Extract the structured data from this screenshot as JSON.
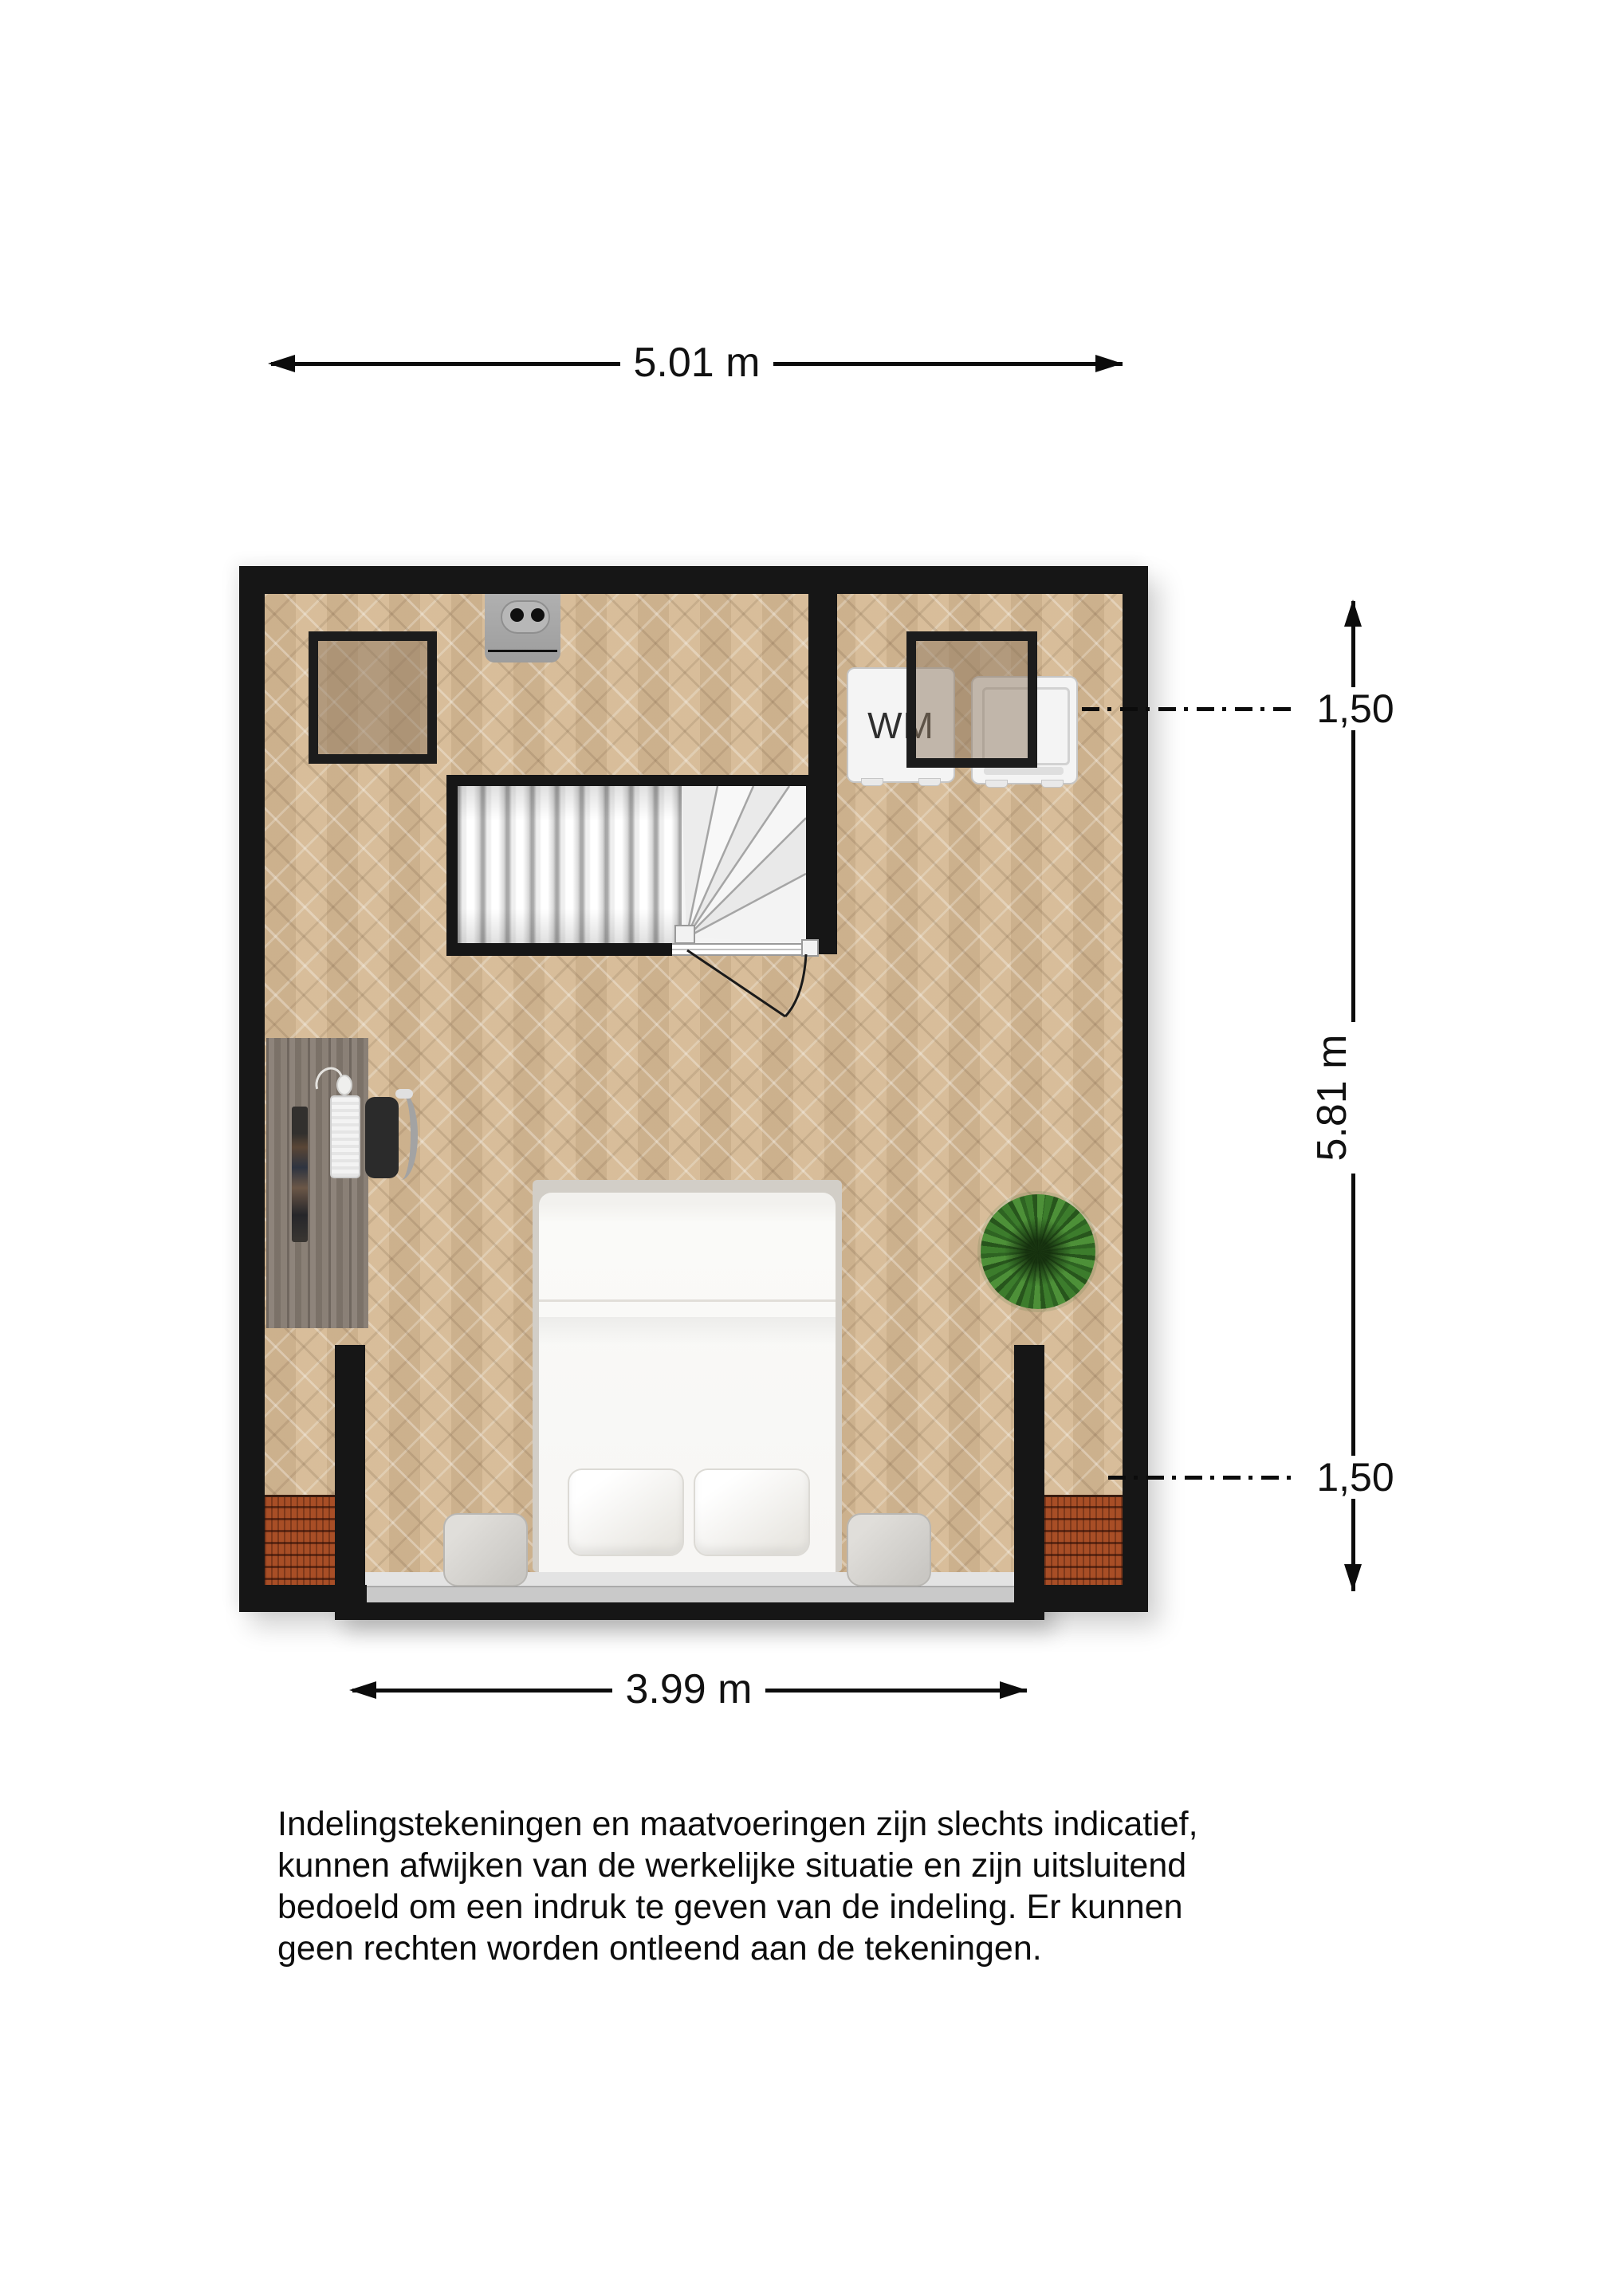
{
  "plan": {
    "dimension_width_top": "5.01 m",
    "dimension_height_right": "5.81 m",
    "dimension_width_bottom": "3.99 m",
    "headroom_upper": "1,50",
    "headroom_lower": "1,50",
    "appliance_label": "WM"
  },
  "disclaimer": {
    "lines": [
      "Indelingstekeningen en maatvoeringen zijn slechts indicatief,",
      "kunnen afwijken van de werkelijke situatie en zijn uitsluitend",
      "bedoeld om een indruk te geven van de indeling. Er kunnen",
      "geen rechten worden ontleend aan de tekeningen."
    ]
  },
  "colors": {
    "wall": "#161616",
    "floor": "#d2b794",
    "roof_tiles": "#a84e26",
    "dimension_text": "#0c0c0c",
    "stair_tread": "#f4f4f4"
  },
  "furniture_icons": [
    "staircase-icon",
    "door-swing-icon",
    "bed-icon",
    "pillow-icon",
    "nightstand-icon",
    "desk-icon",
    "monitor-icon",
    "keyboard-icon",
    "mouse-icon",
    "office-chair-icon",
    "plant-icon",
    "washing-machine-icon",
    "dryer-icon",
    "roof-window-icon",
    "sink-icon",
    "roof-tiles-icon",
    "dormer-icon"
  ]
}
